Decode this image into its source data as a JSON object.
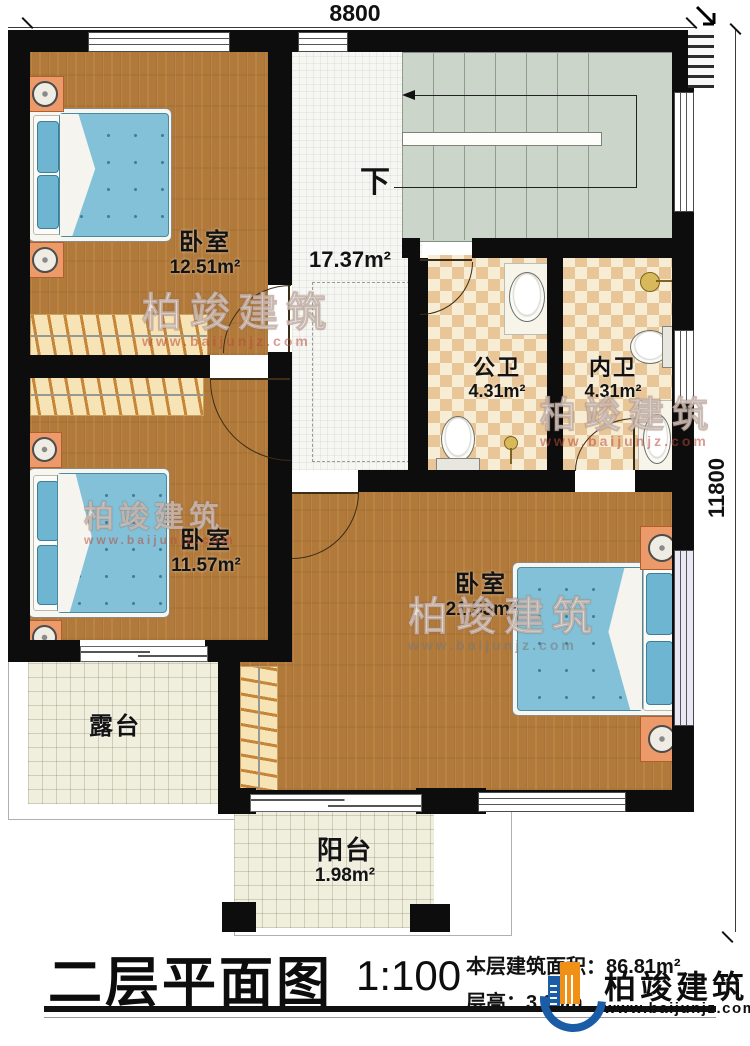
{
  "dimensions": {
    "top_width": "8800",
    "right_height": "11800"
  },
  "rooms": {
    "bedroom_top": {
      "name": "卧室",
      "area": "12.51m²"
    },
    "bedroom_mid": {
      "name": "卧室",
      "area": "11.57m²"
    },
    "bedroom_master": {
      "name": "卧室",
      "area": "21.53m²"
    },
    "bath_public": {
      "name": "公卫",
      "area": "4.31m²"
    },
    "bath_ensuite": {
      "name": "内卫",
      "area": "4.31m²"
    },
    "terrace": {
      "name": "露台"
    },
    "balcony": {
      "name": "阳台",
      "area": "1.98m²"
    },
    "hall": {
      "area": "17.37m²"
    }
  },
  "stairs": {
    "down_label": "下"
  },
  "titleblock": {
    "title": "二层平面图",
    "scale": "1:100",
    "area_line": "本层建筑面积：86.81m²",
    "height_label": "层高：",
    "height_value": "3.00m"
  },
  "brand": {
    "name": "柏竣建筑",
    "url": "www.baijunjz.com"
  },
  "watermark": {
    "name": "柏竣建筑",
    "url": "www.baijunjz.com"
  },
  "icons": {
    "stair_direction": "left-arrow",
    "corner_arrow": "down-right-arrow",
    "dimension_tick": "slash"
  },
  "colors": {
    "wall": "#0d0d0d",
    "wood": "#b1793a",
    "tile_dark": "#e9c697",
    "tile_light": "#f7ecd4",
    "stair": "#ccd5ca",
    "terrace": "#f0eedd",
    "mattress": "#82c1d8",
    "nightstand": "#ec9a6a",
    "logo_blue": "#1b5ca6",
    "logo_orange": "#f19016"
  }
}
